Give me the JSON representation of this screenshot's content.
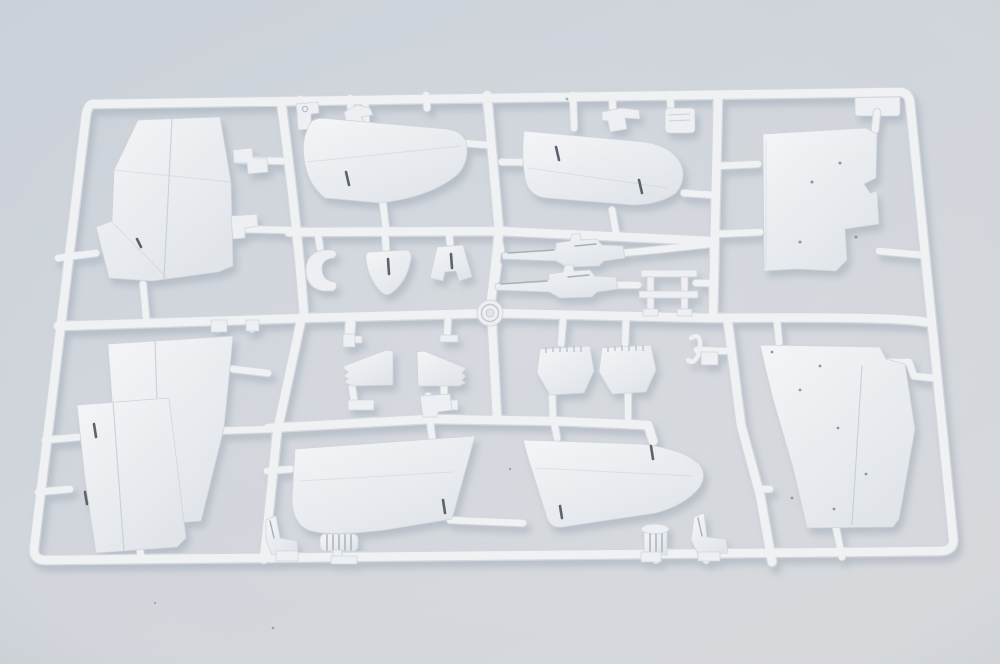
{
  "meta": {
    "alt": "Injection-moulded sprue of light grey plastic aircraft model parts on a pale blue-grey surface"
  },
  "colors": {
    "bgtop": "#cbd1d9",
    "bgmid": "#d2d6dc",
    "bgbot": "#d7d9dc",
    "runner": "#eff1f3",
    "runneredge": "#d3d8df",
    "plastic": "#edeff2",
    "plastichi": "#f4f5f7",
    "plasticlo": "#e1e5ea",
    "partedge": "#d0d5dc",
    "seam": "#c2c8d1",
    "slot": "#5d646d",
    "detail": "#a8afb9",
    "dotcol": "#8f969f",
    "shadow": "#95a0ae",
    "speck": "#6e7680"
  },
  "parts": [
    {
      "name": "sprue-frame"
    },
    {
      "name": "top-left-wing-panel"
    },
    {
      "name": "left-stabilizer-panel"
    },
    {
      "name": "right-stabilizer-panel"
    },
    {
      "name": "top-right-fuselage-panel"
    },
    {
      "name": "bottom-left-wing-panel-rear"
    },
    {
      "name": "bottom-left-wing-panel-front"
    },
    {
      "name": "center-wing-panel-left"
    },
    {
      "name": "center-wing-panel-right"
    },
    {
      "name": "small-fin-left"
    },
    {
      "name": "small-fin-right"
    },
    {
      "name": "bulkhead-left"
    },
    {
      "name": "bulkhead-right"
    },
    {
      "name": "machine-gun-upper"
    },
    {
      "name": "machine-gun-lower"
    },
    {
      "name": "ladder-frame"
    },
    {
      "name": "horseshoe-clamp"
    },
    {
      "name": "shield-plate"
    },
    {
      "name": "notched-plate"
    },
    {
      "name": "bottom-right-wing-panel"
    },
    {
      "name": "pilot-seat-left"
    },
    {
      "name": "ribbed-cylinder"
    },
    {
      "name": "flanged-cylinder"
    },
    {
      "name": "pilot-seat-right"
    },
    {
      "name": "hook"
    },
    {
      "name": "mold-hub"
    }
  ]
}
